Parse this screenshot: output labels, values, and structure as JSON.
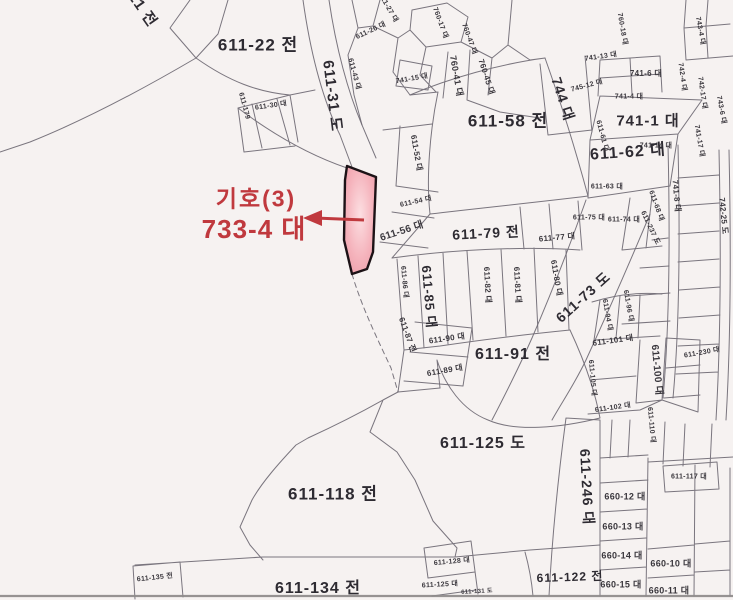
{
  "annotation": {
    "symbol": "기호(3)",
    "parcel": "733-4 대",
    "color": "#c0393e"
  },
  "highlight": {
    "parcel_id": "733-4",
    "fill_center": "#fcdfe2",
    "fill_mid": "#f5b3bc",
    "fill_edge": "#ea96a3",
    "stroke": "#1c1216"
  },
  "map": {
    "background": "#f6f2f1",
    "line_color": "#6f6a74",
    "label_color": "#3a373d",
    "labels": [
      {
        "t": "611-21 전",
        "x": 133,
        "y": -4,
        "r": 55,
        "s": 15
      },
      {
        "t": "611-22 전",
        "x": 258,
        "y": 45,
        "r": 0,
        "s": 17
      },
      {
        "t": "611-31 도",
        "x": 332,
        "y": 96,
        "r": 83,
        "s": 15
      },
      {
        "t": "611-179",
        "x": 244,
        "y": 106,
        "r": 75,
        "s": 7
      },
      {
        "t": "611-30 대",
        "x": 271,
        "y": 106,
        "r": -8,
        "s": 7
      },
      {
        "t": "611-27 대",
        "x": 388,
        "y": 8,
        "r": 60,
        "s": 7
      },
      {
        "t": "611-26 대",
        "x": 371,
        "y": 31,
        "r": -25,
        "s": 7
      },
      {
        "t": "611-43 대",
        "x": 354,
        "y": 74,
        "r": 75,
        "s": 7
      },
      {
        "t": "741-15 대",
        "x": 412,
        "y": 79,
        "r": -10,
        "s": 7
      },
      {
        "t": "760-17 대",
        "x": 440,
        "y": 23,
        "r": 70,
        "s": 7
      },
      {
        "t": "760-47 대",
        "x": 469,
        "y": 39,
        "r": 70,
        "s": 7
      },
      {
        "t": "760-41 대",
        "x": 456,
        "y": 76,
        "r": 80,
        "s": 9
      },
      {
        "t": "760-45 대",
        "x": 486,
        "y": 77,
        "r": 72,
        "s": 8
      },
      {
        "t": "760-18 대",
        "x": 622,
        "y": 29,
        "r": 80,
        "s": 7
      },
      {
        "t": "741-13 대",
        "x": 601,
        "y": 57,
        "r": -8,
        "s": 7
      },
      {
        "t": "745-12 대",
        "x": 587,
        "y": 86,
        "r": -15,
        "s": 7
      },
      {
        "t": "741-6 대",
        "x": 646,
        "y": 74,
        "r": 0,
        "s": 8
      },
      {
        "t": "741-4 대",
        "x": 629,
        "y": 97,
        "r": 0,
        "s": 7
      },
      {
        "t": "743-4 대",
        "x": 700,
        "y": 31,
        "r": 80,
        "s": 7
      },
      {
        "t": "742-4 대",
        "x": 682,
        "y": 77,
        "r": 82,
        "s": 7
      },
      {
        "t": "742-17 대",
        "x": 702,
        "y": 93,
        "r": 82,
        "s": 7
      },
      {
        "t": "743-6 대",
        "x": 721,
        "y": 110,
        "r": 80,
        "s": 7
      },
      {
        "t": "741-14 대",
        "x": 656,
        "y": 146,
        "r": 0,
        "s": 7
      },
      {
        "t": "741-17 대",
        "x": 699,
        "y": 141,
        "r": 80,
        "s": 7
      },
      {
        "t": "744 대",
        "x": 563,
        "y": 99,
        "r": 72,
        "s": 14
      },
      {
        "t": "741-1 대",
        "x": 648,
        "y": 121,
        "r": 0,
        "s": 15
      },
      {
        "t": "611-58 전",
        "x": 508,
        "y": 121,
        "r": 0,
        "s": 17
      },
      {
        "t": "611-62 대",
        "x": 628,
        "y": 153,
        "r": -4,
        "s": 16
      },
      {
        "t": "611-61 대",
        "x": 602,
        "y": 136,
        "r": 75,
        "s": 7
      },
      {
        "t": "611-52 대",
        "x": 416,
        "y": 153,
        "r": 80,
        "s": 8
      },
      {
        "t": "611-54 대",
        "x": 416,
        "y": 202,
        "r": -12,
        "s": 7
      },
      {
        "t": "611-56 대",
        "x": 402,
        "y": 232,
        "r": -18,
        "s": 10
      },
      {
        "t": "611-63 대",
        "x": 607,
        "y": 187,
        "r": 0,
        "s": 7
      },
      {
        "t": "611-68 대",
        "x": 656,
        "y": 206,
        "r": 70,
        "s": 7
      },
      {
        "t": "611-237 도",
        "x": 650,
        "y": 228,
        "r": 65,
        "s": 7
      },
      {
        "t": "611-75 대",
        "x": 589,
        "y": 218,
        "r": 0,
        "s": 7
      },
      {
        "t": "611-74 대",
        "x": 624,
        "y": 220,
        "r": 0,
        "s": 7
      },
      {
        "t": "741-8 대",
        "x": 676,
        "y": 196,
        "r": 85,
        "s": 8
      },
      {
        "t": "742-25 도",
        "x": 723,
        "y": 216,
        "r": 85,
        "s": 8
      },
      {
        "t": "611-79 전",
        "x": 486,
        "y": 233,
        "r": -3,
        "s": 14
      },
      {
        "t": "611-77 대",
        "x": 557,
        "y": 238,
        "r": -5,
        "s": 8
      },
      {
        "t": "611-73 도",
        "x": 583,
        "y": 297,
        "r": -42,
        "s": 14
      },
      {
        "t": "611-86 대",
        "x": 404,
        "y": 282,
        "r": 85,
        "s": 7
      },
      {
        "t": "611-85 대",
        "x": 429,
        "y": 297,
        "r": 85,
        "s": 13
      },
      {
        "t": "611-82 대",
        "x": 487,
        "y": 285,
        "r": 87,
        "s": 8
      },
      {
        "t": "611-81 대",
        "x": 517,
        "y": 285,
        "r": 87,
        "s": 8
      },
      {
        "t": "611-80 대",
        "x": 556,
        "y": 278,
        "r": 80,
        "s": 8
      },
      {
        "t": "611-87 전",
        "x": 407,
        "y": 335,
        "r": 70,
        "s": 8
      },
      {
        "t": "611-90 대",
        "x": 447,
        "y": 339,
        "r": -8,
        "s": 8
      },
      {
        "t": "611-89 대",
        "x": 445,
        "y": 371,
        "r": -10,
        "s": 8
      },
      {
        "t": "611-91 전",
        "x": 513,
        "y": 355,
        "r": 0,
        "s": 16
      },
      {
        "t": "611-94 대",
        "x": 607,
        "y": 315,
        "r": 80,
        "s": 7
      },
      {
        "t": "611-96 대",
        "x": 628,
        "y": 306,
        "r": 80,
        "s": 7
      },
      {
        "t": "611-101 대",
        "x": 613,
        "y": 341,
        "r": -8,
        "s": 8
      },
      {
        "t": "611-100 대",
        "x": 656,
        "y": 370,
        "r": 85,
        "s": 10
      },
      {
        "t": "611-105 대",
        "x": 592,
        "y": 378,
        "r": 85,
        "s": 7
      },
      {
        "t": "611-230 대",
        "x": 702,
        "y": 353,
        "r": -10,
        "s": 7
      },
      {
        "t": "611-102 대",
        "x": 613,
        "y": 408,
        "r": -8,
        "s": 7
      },
      {
        "t": "611-110 대",
        "x": 651,
        "y": 425,
        "r": 85,
        "s": 7
      },
      {
        "t": "611-125 도",
        "x": 483,
        "y": 444,
        "r": 0,
        "s": 16
      },
      {
        "t": "611-246 대",
        "x": 587,
        "y": 487,
        "r": 87,
        "s": 14
      },
      {
        "t": "611-117 대",
        "x": 689,
        "y": 477,
        "r": 0,
        "s": 7
      },
      {
        "t": "660-12 대",
        "x": 625,
        "y": 497,
        "r": 0,
        "s": 9
      },
      {
        "t": "660-13 대",
        "x": 623,
        "y": 527,
        "r": 0,
        "s": 9
      },
      {
        "t": "660-14 대",
        "x": 622,
        "y": 556,
        "r": 0,
        "s": 9
      },
      {
        "t": "660-15 대",
        "x": 621,
        "y": 585,
        "r": 0,
        "s": 9
      },
      {
        "t": "660-10 대",
        "x": 671,
        "y": 564,
        "r": 0,
        "s": 9
      },
      {
        "t": "660-11 대",
        "x": 669,
        "y": 591,
        "r": 0,
        "s": 9
      },
      {
        "t": "611-118 전",
        "x": 333,
        "y": 494,
        "r": 0,
        "s": 17
      },
      {
        "t": "611-134 전",
        "x": 318,
        "y": 589,
        "r": 0,
        "s": 16
      },
      {
        "t": "611-135 전",
        "x": 155,
        "y": 578,
        "r": -6,
        "s": 7
      },
      {
        "t": "611-128 대",
        "x": 452,
        "y": 562,
        "r": -5,
        "s": 7
      },
      {
        "t": "611-125 대",
        "x": 440,
        "y": 585,
        "r": -3,
        "s": 7
      },
      {
        "t": "611-131 도",
        "x": 477,
        "y": 592,
        "r": -3,
        "s": 6
      },
      {
        "t": "611-122 전",
        "x": 570,
        "y": 577,
        "r": -2,
        "s": 12
      }
    ]
  }
}
